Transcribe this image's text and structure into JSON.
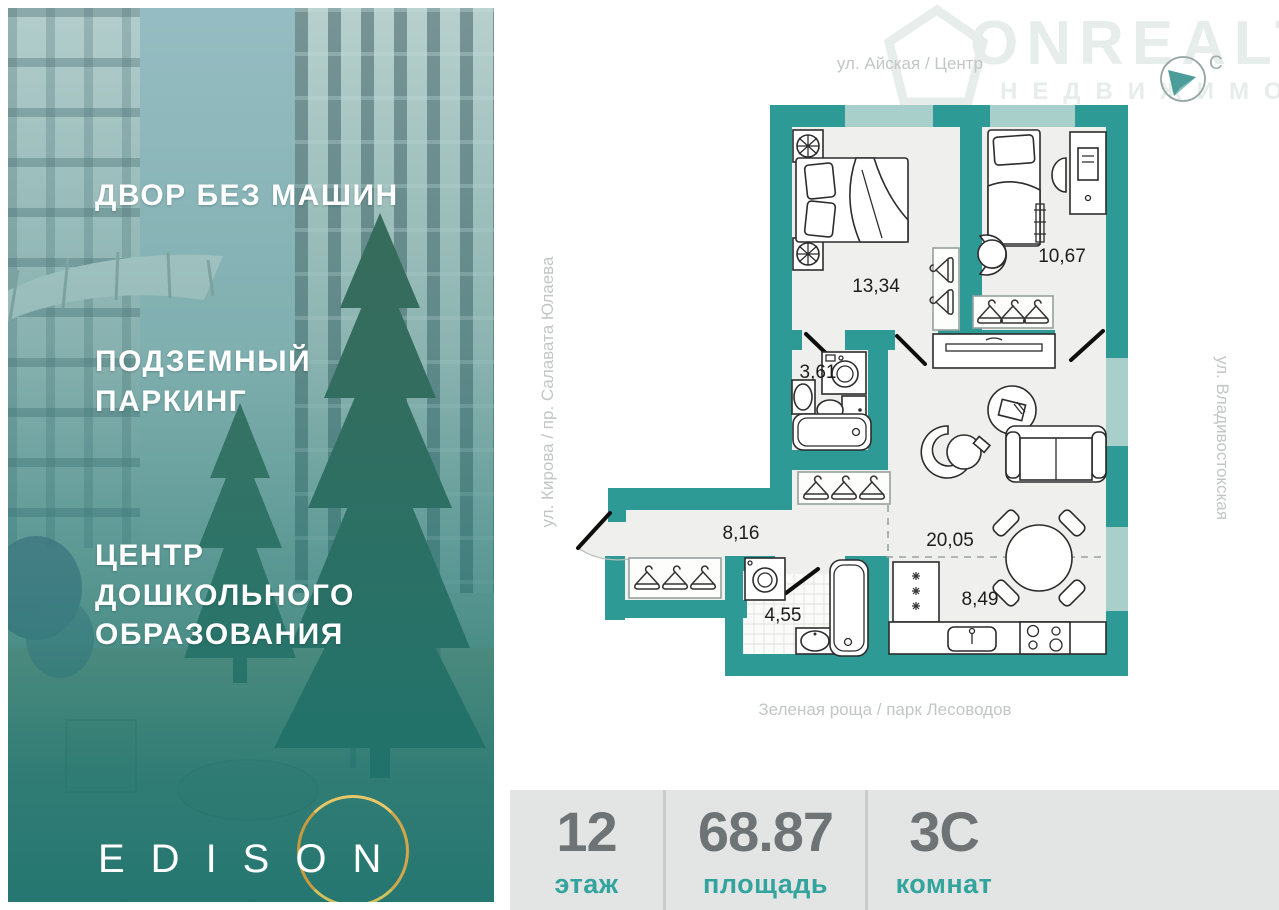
{
  "left_panel": {
    "features": [
      {
        "label": "ДВОР БЕЗ МАШИН"
      },
      {
        "label": "ПОДЗЕМНЫЙ ПАРКИНГ"
      },
      {
        "label": "ЦЕНТР ДОШКОЛЬНОГО ОБРАЗОВАНИЯ"
      }
    ],
    "brand": "EDISON"
  },
  "watermark": {
    "brand": "ONREALT",
    "subtitle": "НЕДВИЖИМОСТЬ"
  },
  "compass": {
    "north_label": "С"
  },
  "streets": {
    "top": "ул. Айская / Центр",
    "right": "ул. Владивостокская",
    "left": "ул. Кирова / пр. Салавата Юлаева",
    "bottom": "Зеленая роща / парк Лесоводов"
  },
  "plan": {
    "rooms": [
      {
        "name": "bedroom",
        "area": "13,34"
      },
      {
        "name": "kids-room",
        "area": "10,67"
      },
      {
        "name": "bathroom",
        "area": "3,61"
      },
      {
        "name": "hallway",
        "area": "8,16"
      },
      {
        "name": "living-room",
        "area": "20,05"
      },
      {
        "name": "bathroom-2",
        "area": "4,55"
      },
      {
        "name": "kitchen",
        "area": "8,49"
      }
    ]
  },
  "stats": [
    {
      "value": "12",
      "label": "этаж"
    },
    {
      "value": "68.87",
      "label": "площадь"
    },
    {
      "value": "3С",
      "label": "комнат"
    }
  ],
  "colors": {
    "wall": "#2E9A96",
    "window": "#A9CFCA",
    "photo_overlay": "#1E7570",
    "gold_ring": "#D2A74B",
    "stat_value": "#6E7376",
    "stat_label": "#33A39E",
    "street_label": "#C3C6C5"
  }
}
